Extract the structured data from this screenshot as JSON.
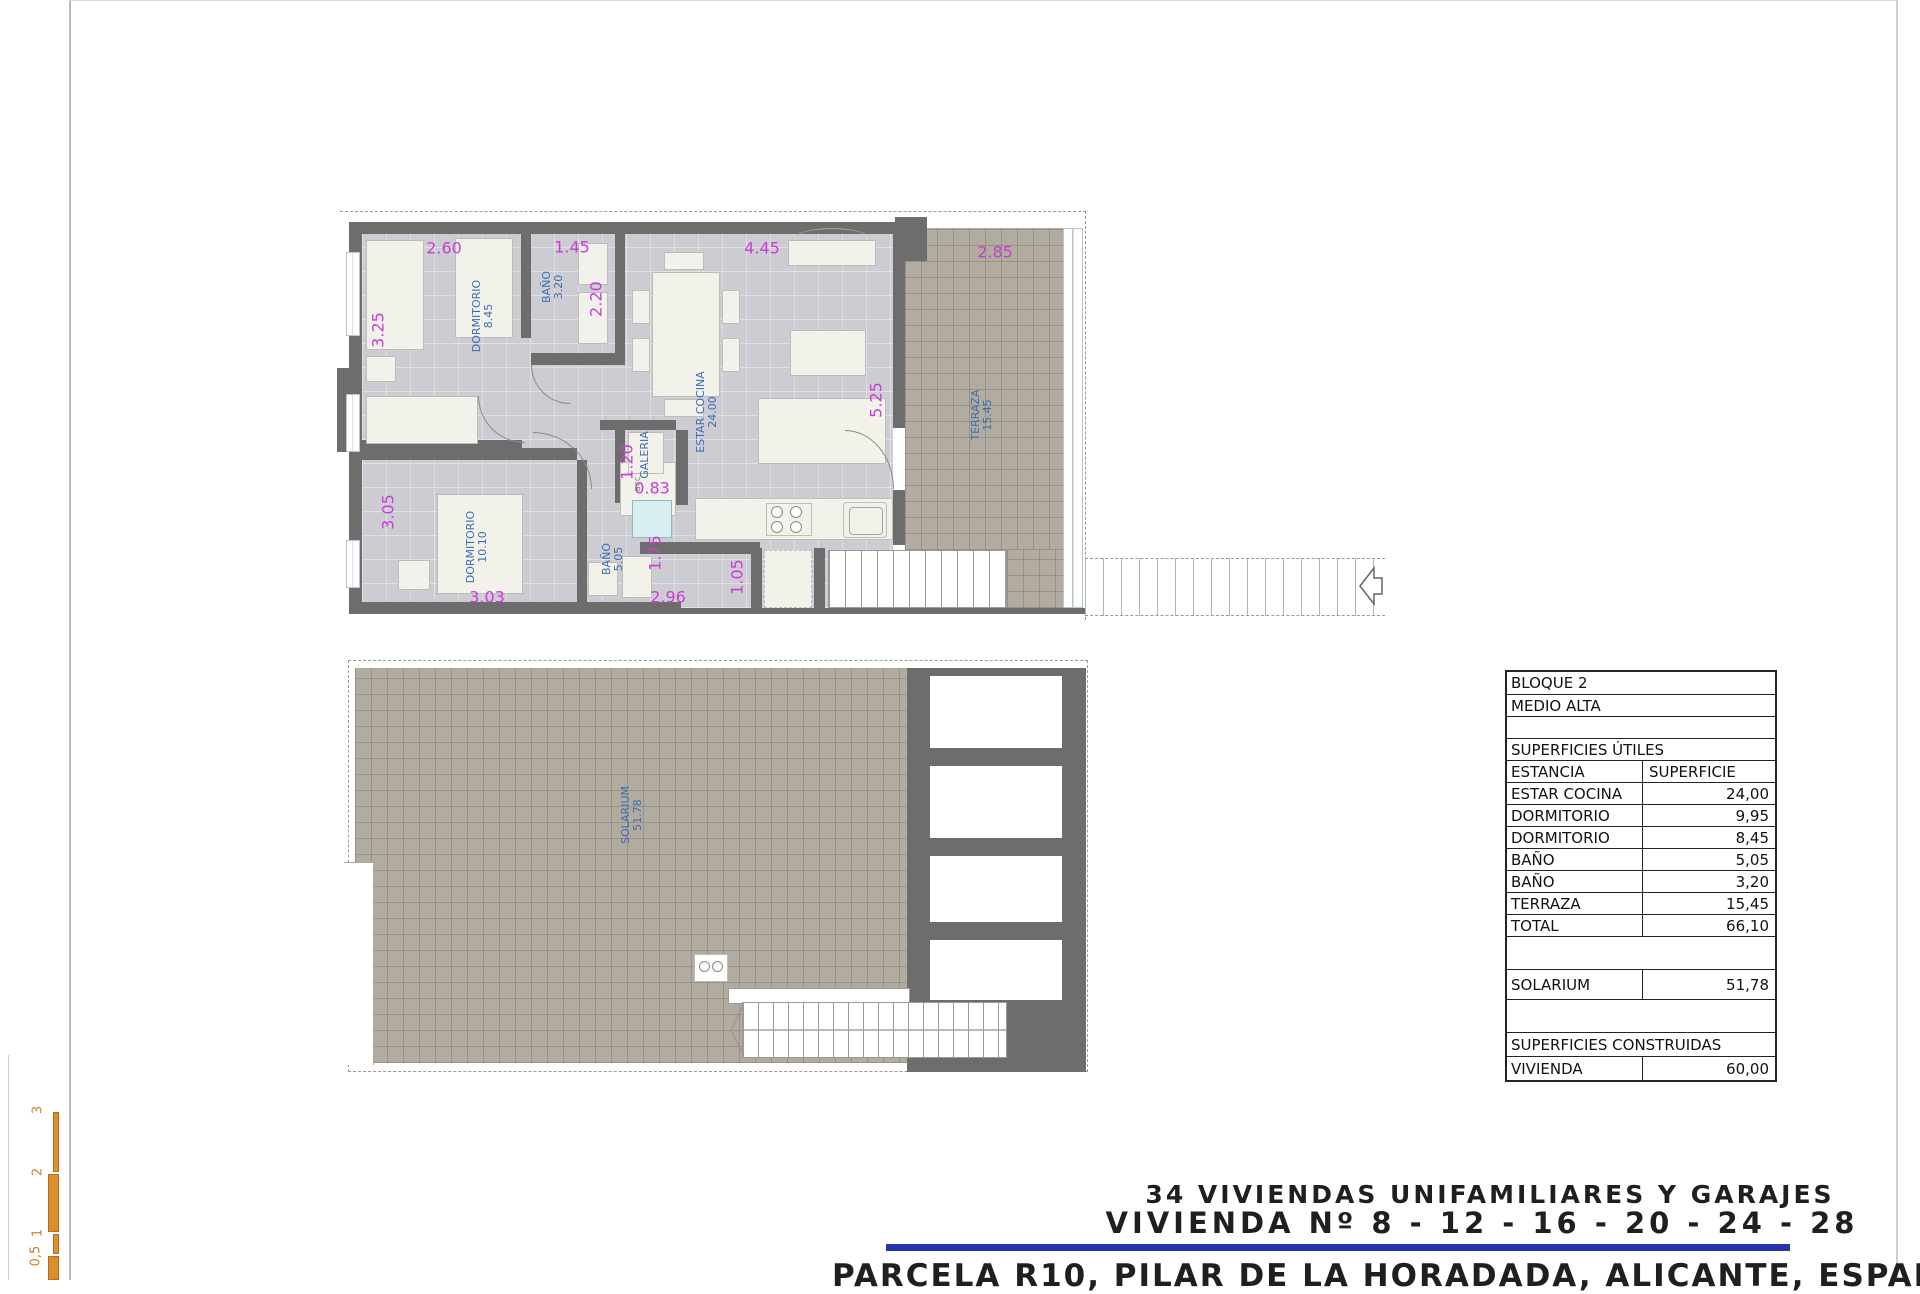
{
  "sheet": {
    "title_block": {
      "line1": "34 VIVIENDAS UNIFAMILIARES Y GARAJES",
      "line2": "VIVIENDA Nº 8 - 12 - 16 - 20 - 24 - 28",
      "line3": "PARCELA R10, PILAR DE LA HORADADA, ALICANTE, ESPAÑA"
    },
    "accent_colors": {
      "dimension_magenta": "#c73ed4",
      "label_blue": "#3a6db3",
      "rule_blue": "#2834ab",
      "scale_orange": "#dd8f2e",
      "wall_gray": "#6d6d6d",
      "tile_beige": "#b2ab9f"
    }
  },
  "scale_bar": {
    "labels": [
      {
        "t": "3",
        "x": 38,
        "y": 1110
      },
      {
        "t": "2",
        "x": 38,
        "y": 1172
      },
      {
        "t": "1",
        "x": 38,
        "y": 1233
      },
      {
        "t": "0,5",
        "x": 36,
        "y": 1256
      }
    ]
  },
  "upper_plan": {
    "dim_labels": [
      {
        "t": "2.60",
        "x": 444,
        "y": 248
      },
      {
        "t": "1.45",
        "x": 572,
        "y": 247
      },
      {
        "t": "4.45",
        "x": 762,
        "y": 248
      },
      {
        "t": "2.85",
        "x": 995,
        "y": 252
      },
      {
        "t": "3.25",
        "x": 378,
        "y": 330,
        "r": 1
      },
      {
        "t": "2.20",
        "x": 596,
        "y": 299,
        "r": 1
      },
      {
        "t": "5.25",
        "x": 876,
        "y": 400,
        "r": 1
      },
      {
        "t": "1.20",
        "x": 627,
        "y": 462,
        "r": 1
      },
      {
        "t": "0.83",
        "x": 652,
        "y": 488
      },
      {
        "t": "3.05",
        "x": 388,
        "y": 512,
        "r": 1
      },
      {
        "t": "3.03",
        "x": 487,
        "y": 597
      },
      {
        "t": "1.75",
        "x": 655,
        "y": 553,
        "r": 1
      },
      {
        "t": "2.96",
        "x": 668,
        "y": 597
      },
      {
        "t": "1.05",
        "x": 737,
        "y": 577,
        "r": 1
      }
    ],
    "room_labels": [
      {
        "n": "DORMITORIO",
        "v": "8.45",
        "x": 483,
        "y": 316
      },
      {
        "n": "BAÑO",
        "v": "3.20",
        "x": 553,
        "y": 287
      },
      {
        "n": "ESTAR COCINA",
        "v": "24.00",
        "x": 707,
        "y": 412
      },
      {
        "n": "GALERIA",
        "v": "",
        "x": 645,
        "y": 455
      },
      {
        "n": "DORMITORIO",
        "v": "10.10",
        "x": 477,
        "y": 547
      },
      {
        "n": "BAÑO",
        "v": "5.05",
        "x": 613,
        "y": 559
      },
      {
        "n": "TERRAZA",
        "v": "15.45",
        "x": 982,
        "y": 415
      }
    ],
    "misc_labels": [
      {
        "t": "acc",
        "x": 638,
        "y": 484
      }
    ]
  },
  "lower_plan": {
    "room_labels": [
      {
        "n": "SOLARIUM",
        "v": "51.78",
        "x": 632,
        "y": 815
      }
    ]
  },
  "area_table": {
    "rows": [
      {
        "label": "BLOQUE 2",
        "value": "",
        "divider": false,
        "h": 22
      },
      {
        "label": "MEDIO ALTA",
        "value": "",
        "divider": false,
        "h": 22
      },
      {
        "label": "",
        "value": "",
        "divider": false,
        "h": 22
      },
      {
        "label": "SUPERFICIES ÚTILES",
        "value": "",
        "divider": false,
        "h": 22
      },
      {
        "label": "ESTANCIA",
        "value": "SUPERFICIE",
        "divider": true,
        "h": 22,
        "value_align": "left"
      },
      {
        "label": "ESTAR COCINA",
        "value": "24,00",
        "divider": true,
        "h": 22
      },
      {
        "label": "DORMITORIO",
        "value": "9,95",
        "divider": true,
        "h": 22
      },
      {
        "label": "DORMITORIO",
        "value": "8,45",
        "divider": true,
        "h": 22
      },
      {
        "label": "BAÑO",
        "value": "5,05",
        "divider": true,
        "h": 22
      },
      {
        "label": "BAÑO",
        "value": "3,20",
        "divider": true,
        "h": 22
      },
      {
        "label": "TERRAZA",
        "value": "15,45",
        "divider": true,
        "h": 22
      },
      {
        "label": "TOTAL",
        "value": "66,10",
        "divider": true,
        "h": 22
      },
      {
        "label": "",
        "value": "",
        "divider": false,
        "h": 33
      },
      {
        "label": "SOLARIUM",
        "value": "51,78",
        "divider": true,
        "h": 30
      },
      {
        "label": "",
        "value": "",
        "divider": false,
        "h": 33
      },
      {
        "label": "SUPERFICIES CONSTRUIDAS",
        "value": "",
        "divider": false,
        "h": 24
      },
      {
        "label": "VIVIENDA",
        "value": "60,00",
        "divider": true,
        "h": 24
      }
    ]
  }
}
